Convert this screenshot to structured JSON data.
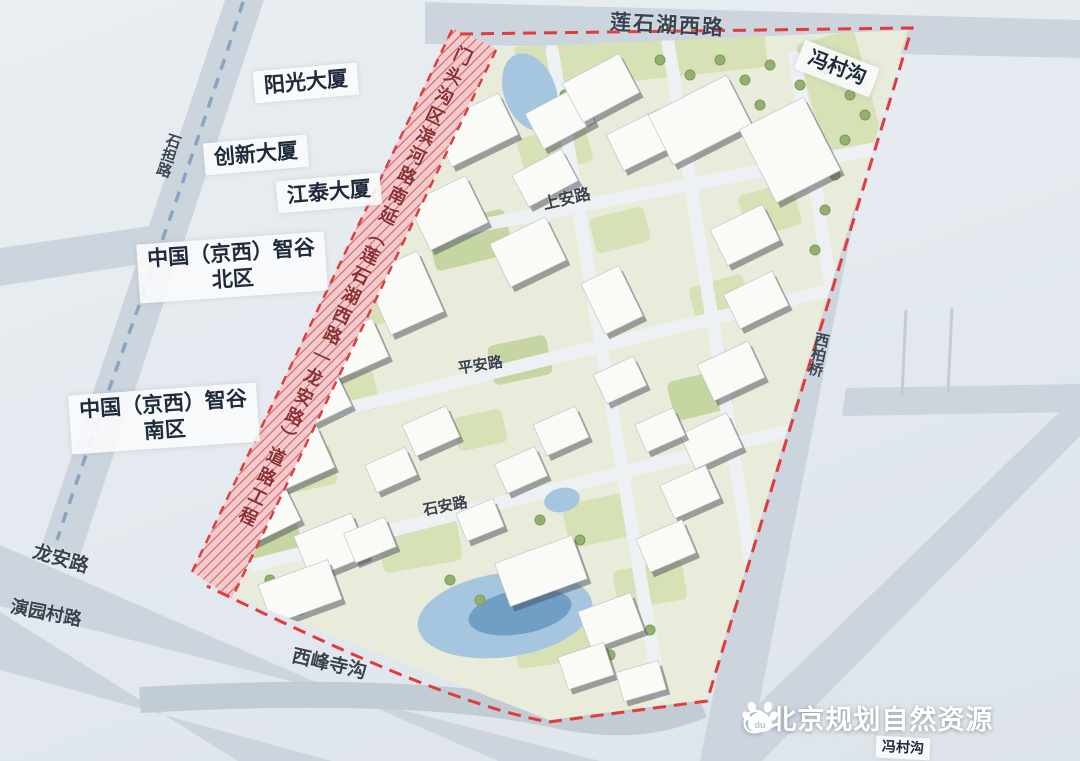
{
  "building_labels": {
    "yangguang": "阳光大厦",
    "chuangxin": "创新大厦",
    "jiangtai": "江泰大厦"
  },
  "districts": {
    "zhigu_north_line1": "中国（京西）智谷",
    "zhigu_north_line2": "北区",
    "zhigu_south_line1": "中国（京西）智谷",
    "zhigu_south_line2": "南区"
  },
  "waterways": {
    "fengcungou_north": "冯村沟",
    "fengcungou_south": "冯村沟",
    "xifengsigou": "西峰寺沟"
  },
  "roads": {
    "lianshihu_west_road": "莲石湖西路",
    "shangan_road": "上安路",
    "pingan_road": "平安路",
    "shian_road": "石安路",
    "shidan_road": "石担路",
    "longan_road": "龙安路",
    "yanyuancun_road": "演园村路",
    "xibai_bridge": "西柏桥"
  },
  "project_corridor_label": "门头沟区滨河路南延（莲石湖西路—龙安路）道路工程",
  "watermark": {
    "handle": "@北京规划自然资源",
    "icon": "baidu-paw-icon",
    "paw_text": "du"
  },
  "colors": {
    "boundary_red": "#e23b3b",
    "corridor_pink": "#f2cbce",
    "planned_road_blue": "#8aa4c4",
    "water_blue": "#a5c6de",
    "green_patch": "#d6e1b6",
    "road_gray": "#ccd5de"
  }
}
